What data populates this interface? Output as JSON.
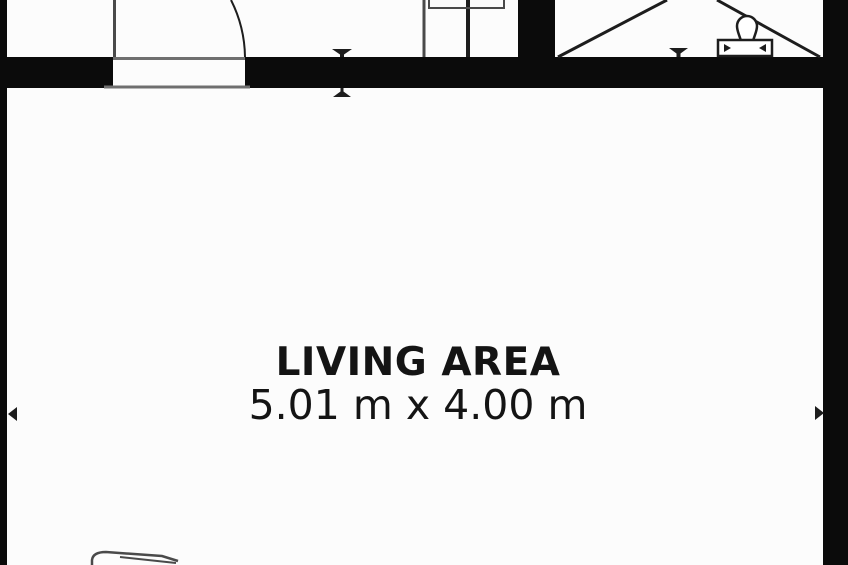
{
  "plan": {
    "room_label": "LIVING AREA",
    "room_dimensions": "5.01 m x 4.00 m"
  },
  "elements": {
    "door_icon": "door-swing-arc",
    "toilet_icon": "toilet-top-view",
    "counter_icon": "counter-sink-bracket",
    "marker_icon": "opening-alignment-triangle",
    "arrow_icons": "width-dimension-arrows",
    "diagonal_lines": "sloped-area-cross-lines",
    "sofa_icon": "sofa-corner-partial"
  },
  "colors": {
    "background": "#fcfcfc",
    "wall": "#0b0b0b",
    "line_dark": "#1d1d1d",
    "line_mid": "#4a4a4a",
    "line_gray": "#6f6f6f",
    "text": "#141414"
  }
}
